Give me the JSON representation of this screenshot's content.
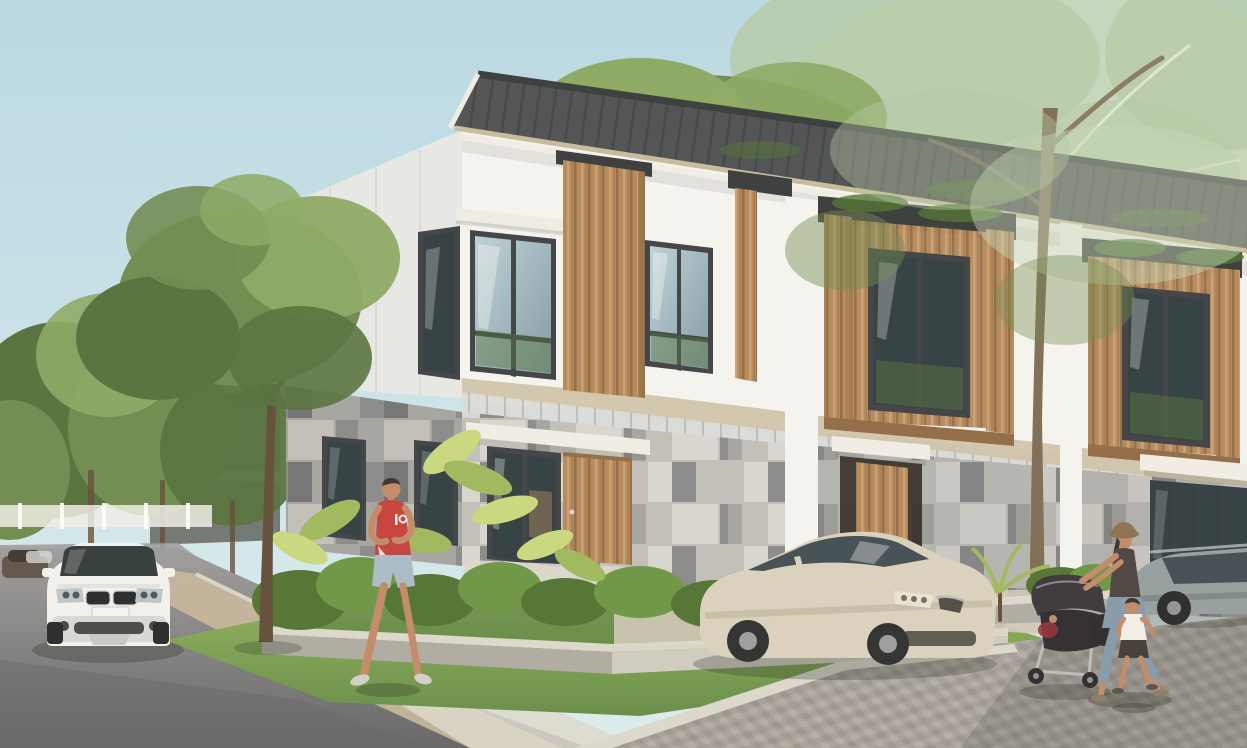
{
  "meta": {
    "type": "architectural-rendering",
    "description": "Photorealistic rendering of a modern two-storey townhouse row at a landscaped street corner: white render and grey stone facades with timber slat screens, dark tiled roof, mature trees, a white SUV on the street, a beige sedan on the paver driveway, a jogger in red, and a woman pushing a stroller with a toddler.",
    "width": 1247,
    "height": 748
  },
  "palette": {
    "sky-top": "#b7d9e6",
    "sky-bottom": "#dbeef1",
    "haze-green": "#c6d6ba",
    "haze-green-2": "#b4cba8",
    "tree-green": "#6d8a50",
    "tree-green-dark": "#52703c",
    "tree-green-light": "#8aa863",
    "leaf-bright": "#9cb85c",
    "leaf-light": "#c8da7e",
    "trunk-brown": "#5f4b38",
    "trunk-light": "#7d6b55",
    "roof-gray": "#4b4e53",
    "roof-dark": "#35383c",
    "fascia-beige": "#c7bb9e",
    "soffit-white": "#efeee8",
    "wall-white": "#f5f5f2",
    "wall-shade": "#e6e8e8",
    "wall-dim": "#d9dcdc",
    "floor-band": "#cfc4ab",
    "wood-tan": "#b3875a",
    "wood-dark": "#8f6a45",
    "wood-light": "#cfa472",
    "frame-dark": "#3a3f44",
    "glass-light": "#bcd3da",
    "glass-dark": "#2e3b42",
    "glass-mid": "#7f9aa6",
    "stone-light": "#d6d6d2",
    "stone-mid": "#bfbfbb",
    "stone-gray": "#a3a4a2",
    "stone-dark": "#87898b",
    "stone-deep": "#707275",
    "canopy-white": "#f1efe8",
    "grass-green": "#85a957",
    "grass-dark": "#648c47",
    "shrub-green": "#6a9444",
    "shrub-dark": "#4d7231",
    "concrete": "#cfccc2",
    "concrete-shade": "#adaba3",
    "curb-light": "#dcd9cf",
    "asphalt": "#8b8c8e",
    "asphalt-dark": "#636467",
    "asphalt-light": "#9b9c9e",
    "sidewalk-tan": "#c3b59c",
    "cobble": "#a5a19b",
    "cobble-dark": "#8d8983",
    "cobble-light": "#b6b2ab",
    "car-white": "#f2f2f0",
    "car-white-shade": "#d9d9d6",
    "car-dark": "#5c5348",
    "sedan-beige": "#d9d2bf",
    "sedan-beige-dark": "#b9b19c",
    "car-gray": "#939da1",
    "car-gray-dark": "#6e787c",
    "skin": "#c08a68",
    "hair-dark": "#39302a",
    "shirt-red": "#c43f3c",
    "shorts-blue": "#a8bccb",
    "shoe-light": "#cfcfcb",
    "vest-dark": "#4a4240",
    "jeans-blue": "#8299ab",
    "hat-brown": "#8a6f4e",
    "stroller-dark": "#37343a",
    "stroller-red": "#8e3038",
    "shadow": "#232a24"
  },
  "scene": {
    "setting": "Modern two-storey townhouse row at a landscaped street corner, daytime",
    "sky": {
      "condition": "clear pale blue, hazy tree canopies upper right"
    },
    "architecture": {
      "style": "contemporary tropical townhouses",
      "storeys": 2,
      "units_visible": 3,
      "facade_materials": [
        "white render",
        "grey stone tile cladding",
        "vertical timber slat screens",
        "dark grey tiled roof"
      ],
      "features": [
        "corner unit",
        "timber and glass entry doors",
        "white entry canopies",
        "dark aluminium window frames",
        "raised concrete planters"
      ]
    },
    "vehicles": [
      {
        "type": "white SUV",
        "position": "driving on street, front view, lower left"
      },
      {
        "type": "dark sedan",
        "position": "distant street behind SUV"
      },
      {
        "type": "beige sedan",
        "position": "parked on paver driveway in front of row"
      },
      {
        "type": "grey wagon",
        "position": "parked far right by corner-unit glass facade"
      }
    ],
    "people": [
      {
        "type": "male jogger",
        "clothing": "red tank top, light blue shorts",
        "position": "running along street edge, centre left"
      },
      {
        "type": "woman with sun hat",
        "clothing": "dark vest, blue jeans",
        "action": "pushing dark stroller",
        "position": "lower right on pavers"
      },
      {
        "type": "toddler boy",
        "clothing": "white t-shirt, dark shorts",
        "position": "walking beside stroller"
      }
    ],
    "vegetation": [
      "large shade trees behind and over the houses",
      "street tree in left planting strip",
      "broad-leaf tropical shrubs in planters",
      "small palms beside driveway",
      "lawn strips"
    ],
    "ground": [
      "dark asphalt street lower left",
      "tan sidewalk band",
      "grey interlocking paver driveway lower right",
      "raised concrete planter walls",
      "concrete kerbs"
    ],
    "lighting": "soft afternoon sun from the right"
  }
}
